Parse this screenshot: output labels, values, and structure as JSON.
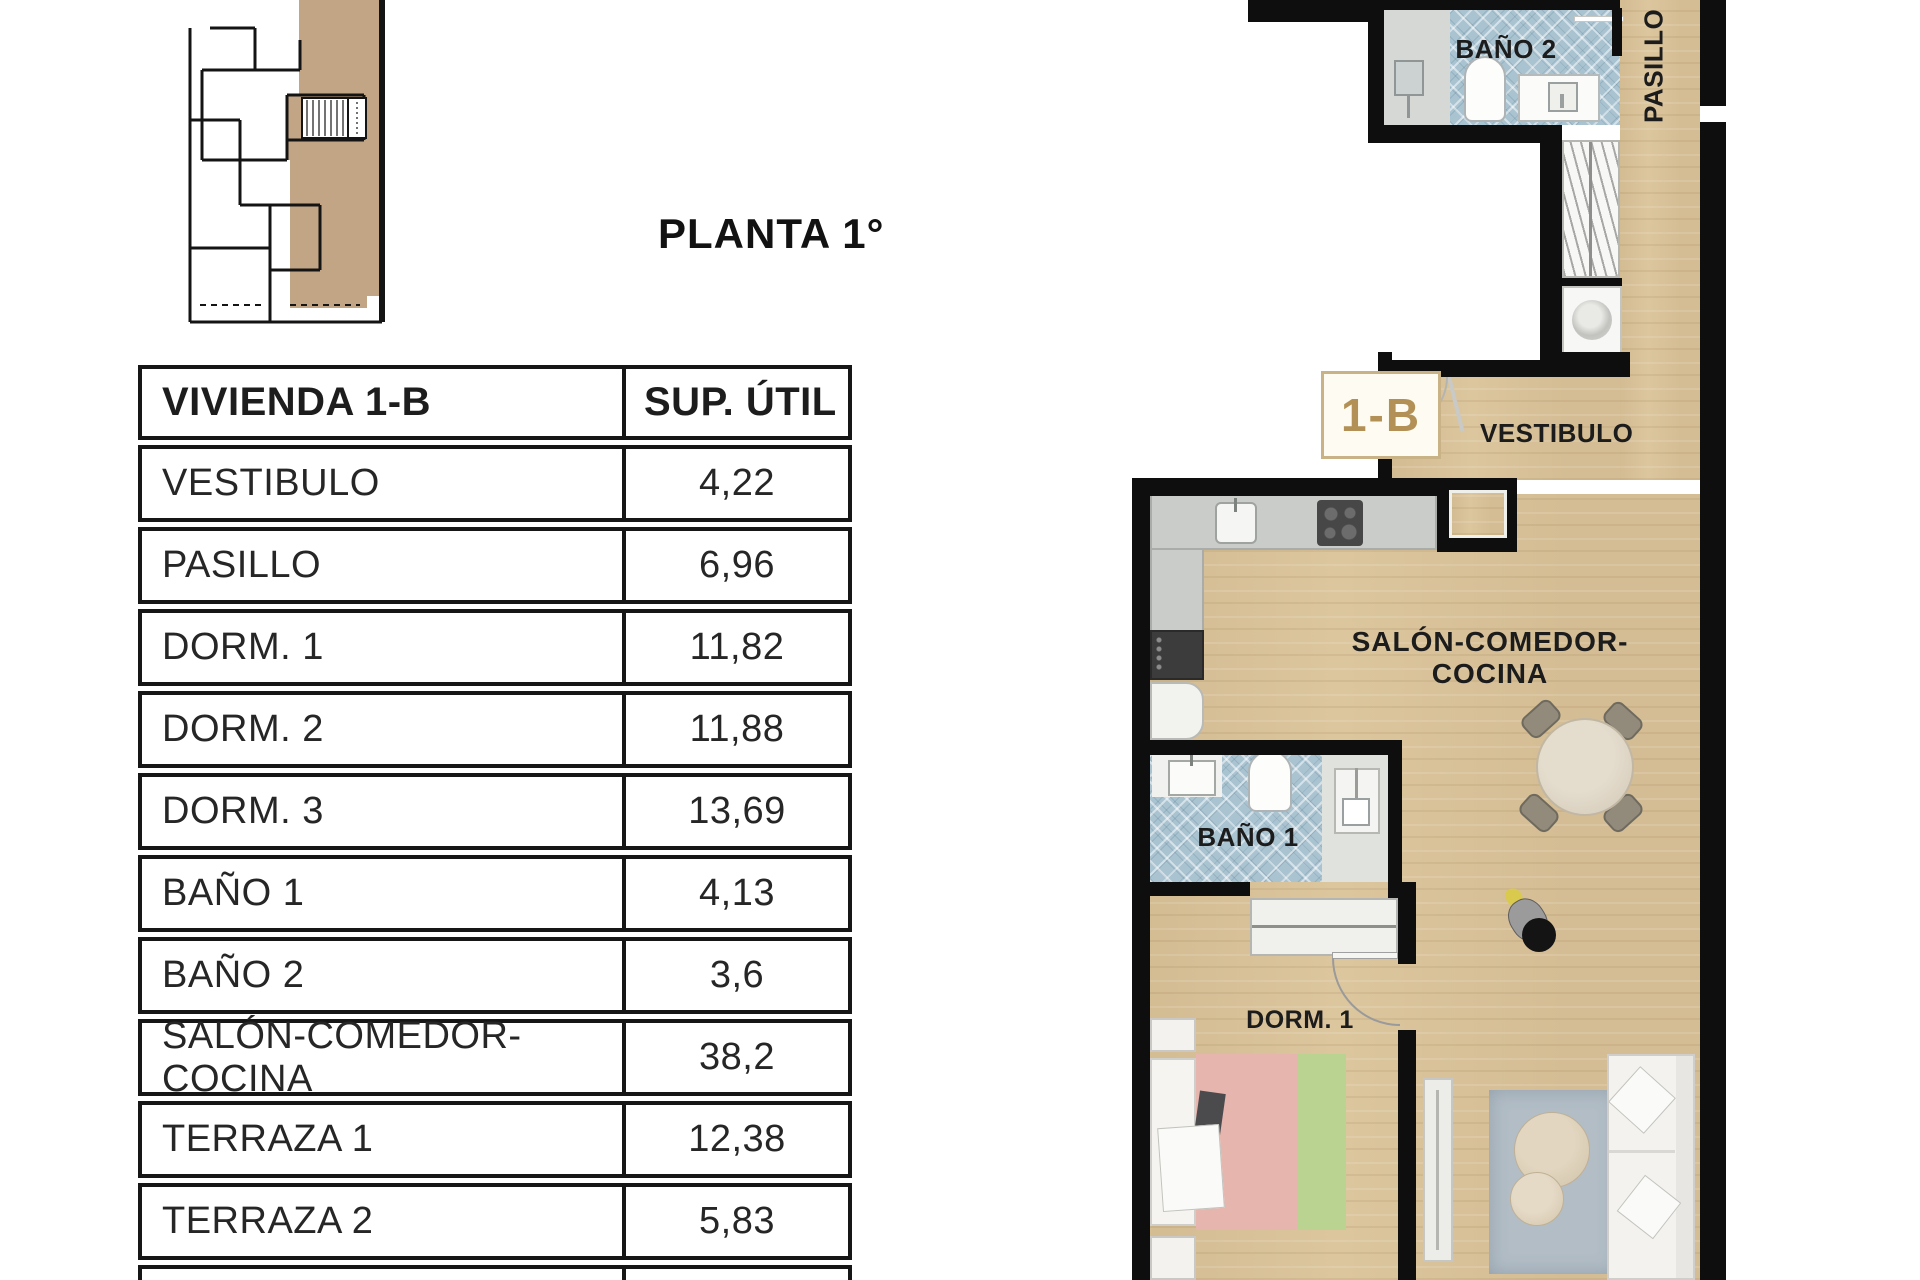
{
  "title": "PLANTA 1°",
  "table": {
    "header": {
      "name": "VIVIENDA 1-B",
      "area": "SUP. ÚTIL"
    },
    "rows": [
      {
        "name": "VESTIBULO",
        "area": "4,22"
      },
      {
        "name": "PASILLO",
        "area": "6,96"
      },
      {
        "name": "DORM. 1",
        "area": "11,82"
      },
      {
        "name": "DORM. 2",
        "area": "11,88"
      },
      {
        "name": "DORM. 3",
        "area": "13,69"
      },
      {
        "name": "BAÑO 1",
        "area": "4,13"
      },
      {
        "name": "BAÑO 2",
        "area": "3,6"
      },
      {
        "name": "SALÓN-COMEDOR-COCINA",
        "area": "38,2"
      },
      {
        "name": "TERRAZA 1",
        "area": "12,38"
      },
      {
        "name": "TERRAZA 2",
        "area": "5,83"
      }
    ]
  },
  "plan": {
    "unit_label": "1-B",
    "labels": {
      "bano2": "BAÑO 2",
      "pasillo": "PASILLO",
      "vestibulo": "VESTIBULO",
      "salon": "SALÓN-COMEDOR-COCINA",
      "bano1": "BAÑO 1",
      "dorm1": "DORM. 1"
    }
  },
  "colors": {
    "wall": "#0e0e0e",
    "wood_floor": "#dcc69e",
    "bath_tile": "#a9c3d1",
    "unit_fill": "#c2a584",
    "unit_accent": "#b39156",
    "rug": "#b2bdc6",
    "counter": "#c9ccc8"
  }
}
